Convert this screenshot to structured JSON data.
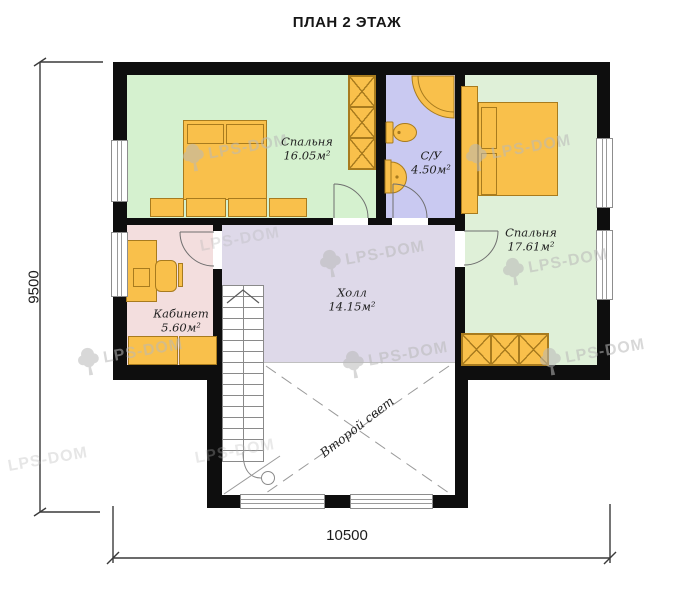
{
  "title": "ПЛАН 2 ЭТАЖ",
  "brand": "LPS-DOM",
  "dimensions": {
    "height_mm": "9500",
    "width_mm": "10500"
  },
  "rooms": {
    "bedroom1": {
      "name": "Спальня",
      "area": "16.05м²"
    },
    "bathroom": {
      "name": "С/У",
      "area": "4.50м²"
    },
    "bedroom2": {
      "name": "Спальня",
      "area": "17.61м²"
    },
    "study": {
      "name": "Кабинет",
      "area": "5.60м²"
    },
    "hall": {
      "name": "Холл",
      "area": "14.15м²"
    },
    "void": {
      "name": "Второй свет"
    }
  },
  "colors": {
    "bedroom1_fill": "#d5f1cf",
    "bedroom2_fill": "#dff0d8",
    "bathroom_fill": "#c9c9f1",
    "hall_fill": "#ded9e9",
    "study_fill": "#f3dede",
    "furniture": "#f9c04b",
    "wall": "#0e0e0e",
    "watermark": "#b9b9b9"
  }
}
